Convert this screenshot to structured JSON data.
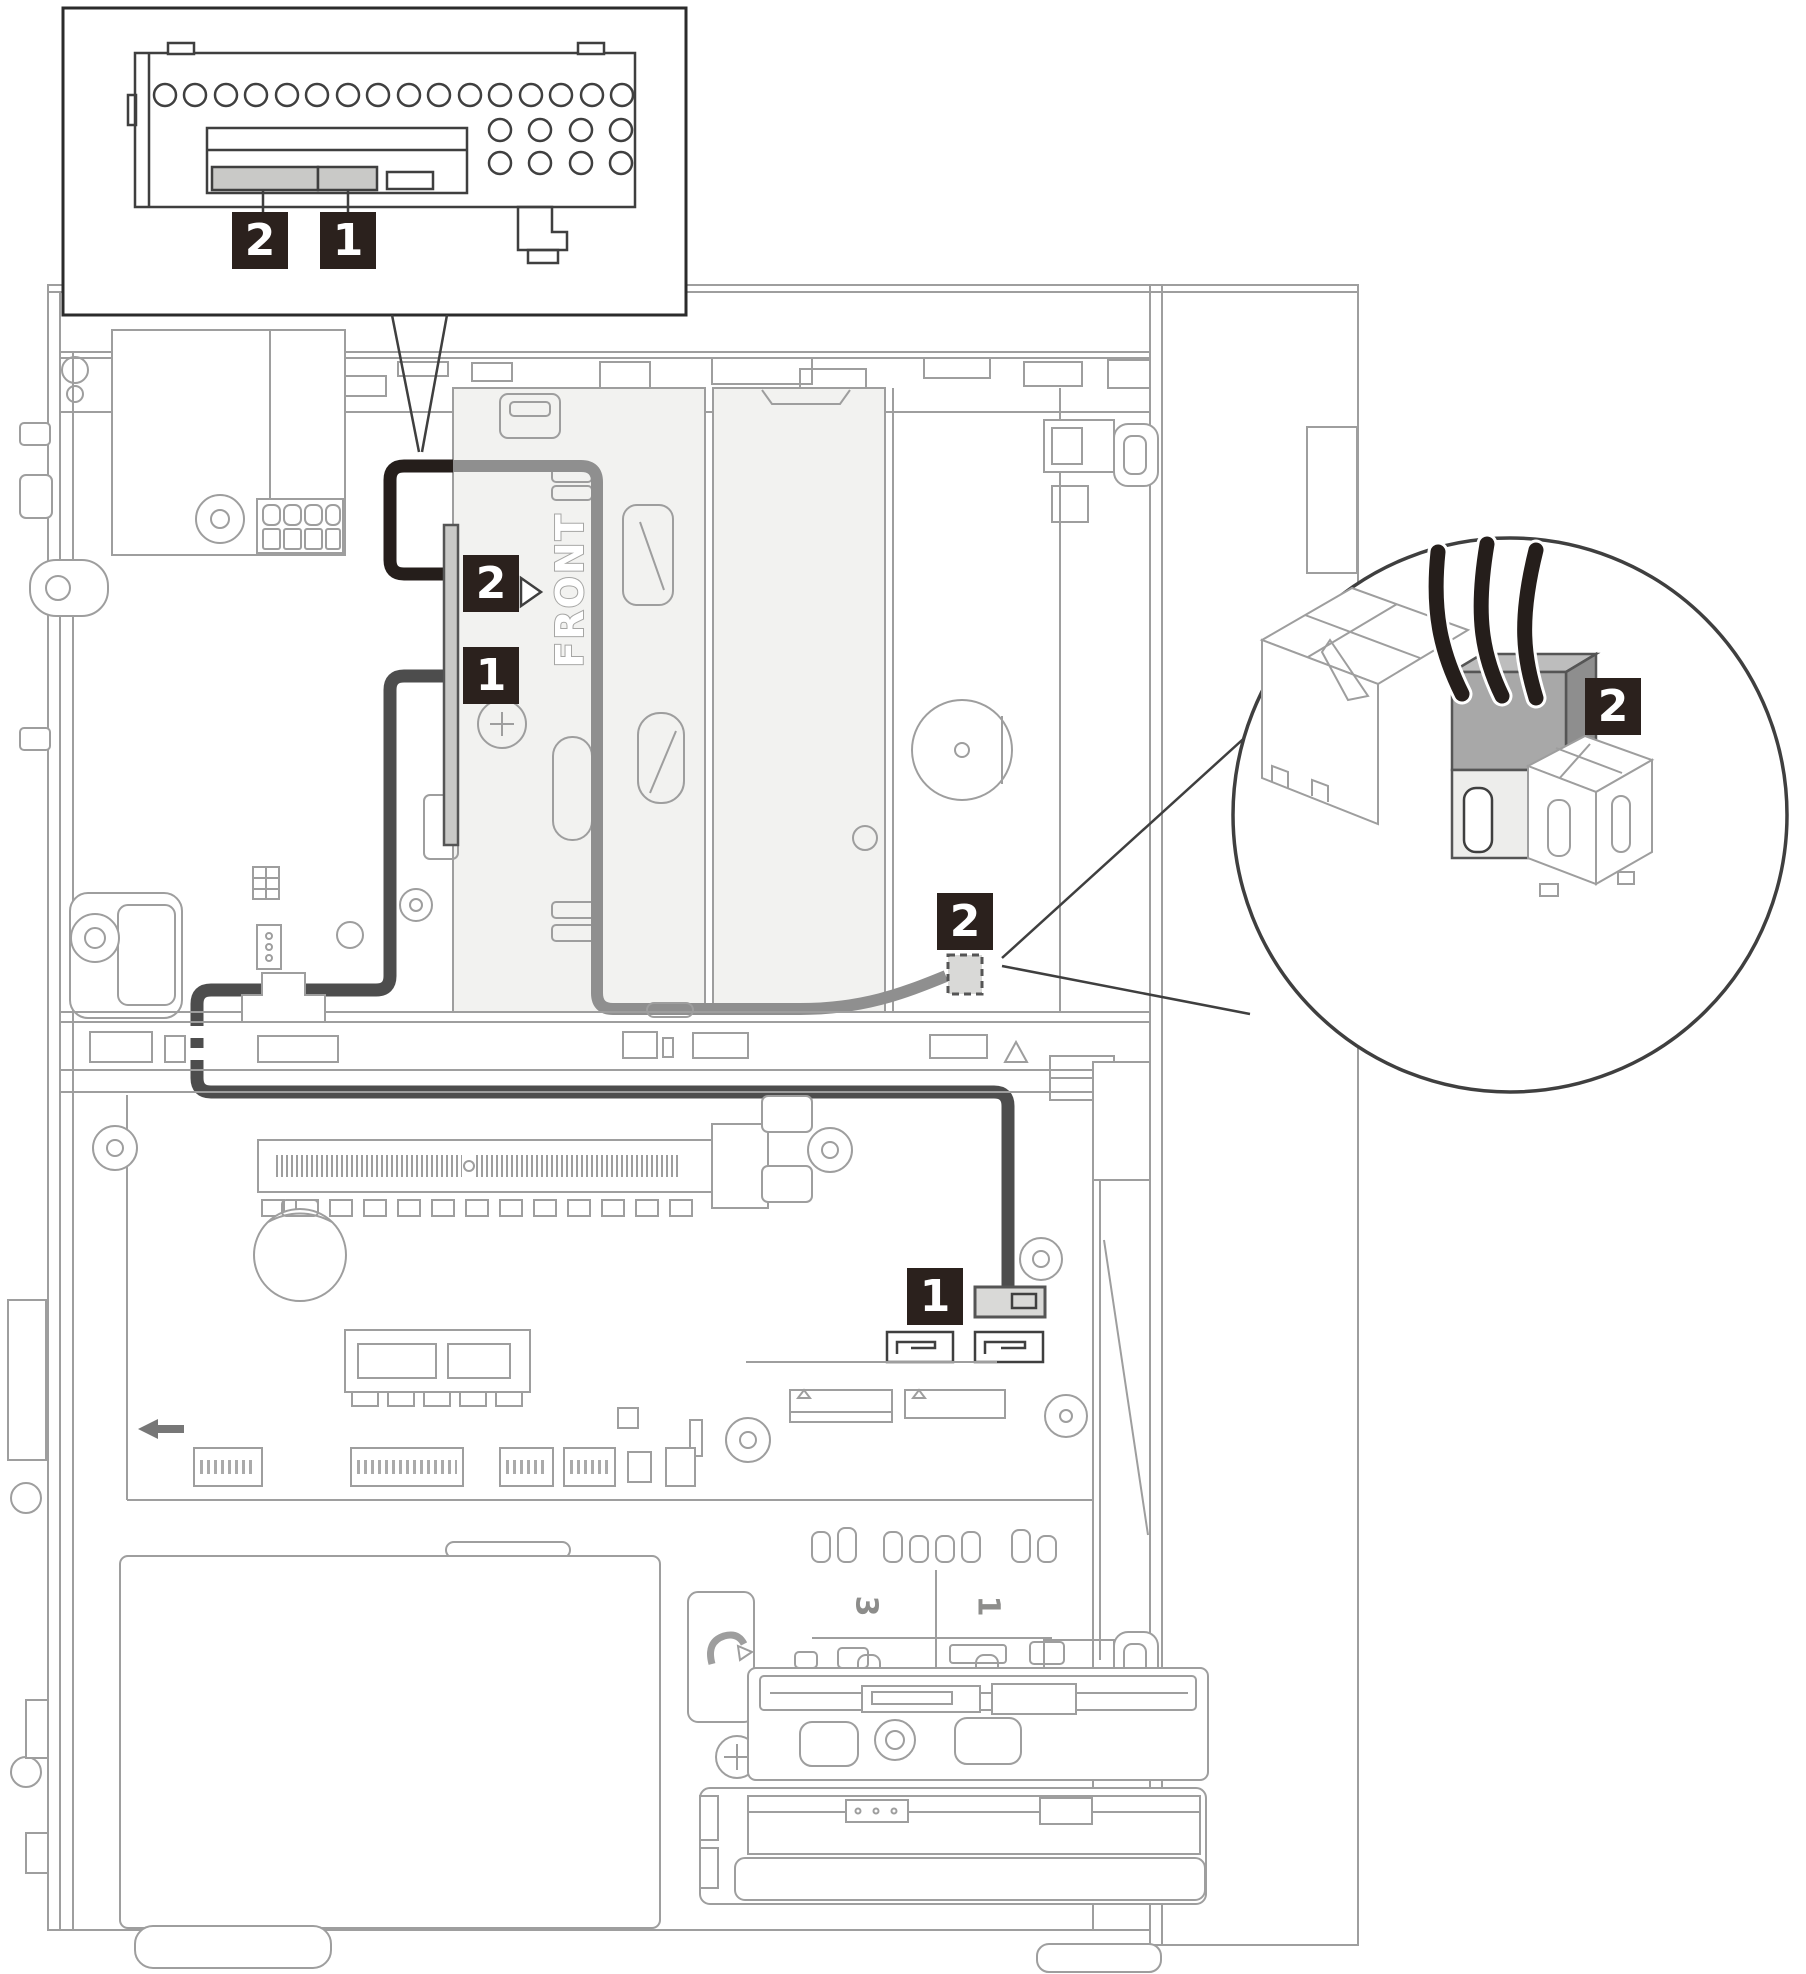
{
  "labels": {
    "one": "1",
    "two": "2",
    "three": "3",
    "front": "FRONT"
  },
  "colors": {
    "line": "#9e9e9e",
    "line_dark": "#3f3f3f",
    "cable_black": "#251e1b",
    "cable_dark": "#4d4d4d",
    "cable_gray": "#8f8f8f",
    "label_bg": "#2b211d",
    "fill_light": "#f2f2f0",
    "connector_gray": "#c9c9c7",
    "connector_dash": "#d9d9d7"
  },
  "callouts": {
    "inset_optical_drive_rear": [
      "2",
      "1"
    ],
    "drive_cage_connectors": [
      "2",
      "1"
    ],
    "power_cable_junction": "2",
    "motherboard_sata_connector": "1",
    "detail_circle_power_connector": "2",
    "chassis_silkscreen": [
      "3",
      "1"
    ],
    "cage_direction_text": "FRONT"
  }
}
